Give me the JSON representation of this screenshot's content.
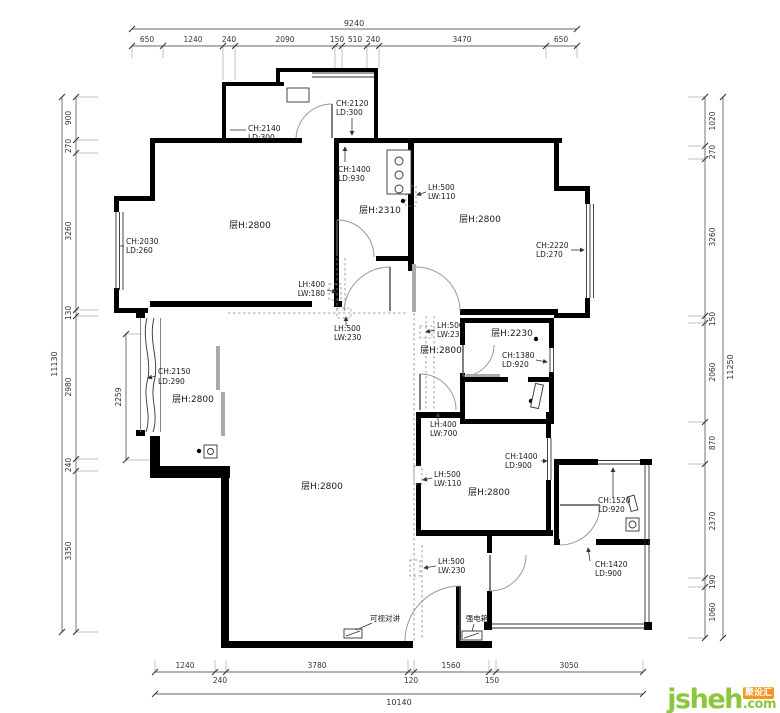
{
  "watermark": {
    "brand": "jsheh",
    "com": ".com",
    "badge": "聚设汇"
  },
  "dims": {
    "top_total": "9240",
    "top": [
      "650",
      "1240",
      "240",
      "2090",
      "150",
      "510",
      "240",
      "3470",
      "650"
    ],
    "bottom_total": "10140",
    "bottom": [
      "1240",
      "240",
      "3780",
      "120",
      "1560",
      "150",
      "3050"
    ],
    "left_total": "11130",
    "left": [
      "900",
      "270",
      "3260",
      "130",
      "2980",
      "240",
      "3350"
    ],
    "left_extra": "2259",
    "right_total": "11250",
    "right": [
      "1020",
      "270",
      "3260",
      "150",
      "2060",
      "870",
      "2370",
      "190",
      "1060"
    ]
  },
  "rooms": {
    "bedroom_tl": "层H:2800",
    "kitchen": "层H:2310",
    "bedroom_tr": "层H:2800",
    "dining": "层H:2800",
    "bath": "层H:2230",
    "bay": "层H:2800",
    "living": "层H:2800",
    "bedroom_br": "层H:2800"
  },
  "notes": {
    "porch_door": [
      "CH:2140",
      "LD:300"
    ],
    "porch_win": [
      "CH:2120",
      "LD:300"
    ],
    "kitchen_win": [
      "CH:1400",
      "LD:930"
    ],
    "left_win": [
      "CH:2030",
      "LD:260"
    ],
    "tl_opening": [
      "LH:400",
      "LW:180"
    ],
    "tr_niche": [
      "LH:500",
      "LW:110"
    ],
    "right_win": [
      "CH:2220",
      "LD:270"
    ],
    "hall_left": [
      "LH:500",
      "LW:230"
    ],
    "hall_right": [
      "LH:500",
      "LW:230"
    ],
    "bath_win": [
      "CH:1380",
      "LD:920"
    ],
    "bath_opening": [
      "LH:400",
      "LW:700"
    ],
    "br_win": [
      "CH:1400",
      "LD:900"
    ],
    "br_niche": [
      "LH:500",
      "LW:110"
    ],
    "storage_win": [
      "CH:1520",
      "LD:920"
    ],
    "balcony_door": [
      "CH:1420",
      "LD:900"
    ],
    "bay_win": [
      "CH:2150",
      "LD:290"
    ],
    "entry_opening": [
      "LH:500",
      "LW:230"
    ]
  },
  "devices": {
    "intercom": "可视对讲",
    "power_box": "强电箱"
  }
}
